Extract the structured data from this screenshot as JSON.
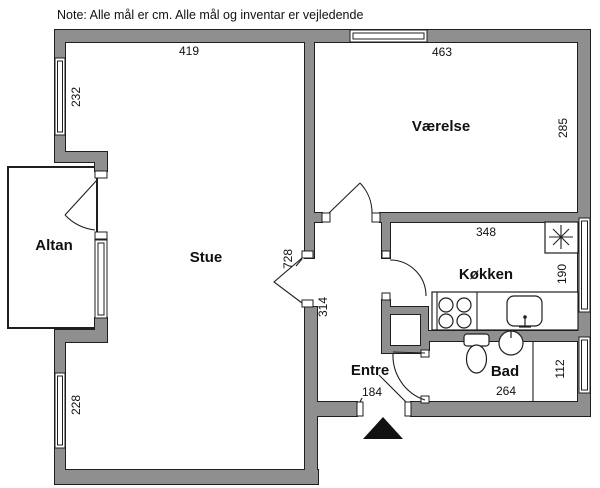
{
  "note": "Note: Alle mål er cm. Alle mål og inventar er vejledende",
  "rooms": {
    "stue": "Stue",
    "vaerelse": "Værelse",
    "koekken": "Køkken",
    "bad": "Bad",
    "entre": "Entre",
    "altan": "Altan"
  },
  "dimensions_cm": {
    "stue_top_width": "419",
    "stue_upper_window": "232",
    "stue_lower_window": "228",
    "stue_length": "728",
    "stue_opening": "314",
    "vaerelse_width": "463",
    "vaerelse_depth": "285",
    "koekken_width": "348",
    "koekken_depth": "190",
    "entre_door_width": "184",
    "bad_width": "264",
    "bad_window": "112"
  },
  "colors": {
    "wall_fill": "#8f8f8f",
    "wall_outline": "#1f1f1f",
    "background": "#ffffff",
    "marker": "#111111"
  }
}
